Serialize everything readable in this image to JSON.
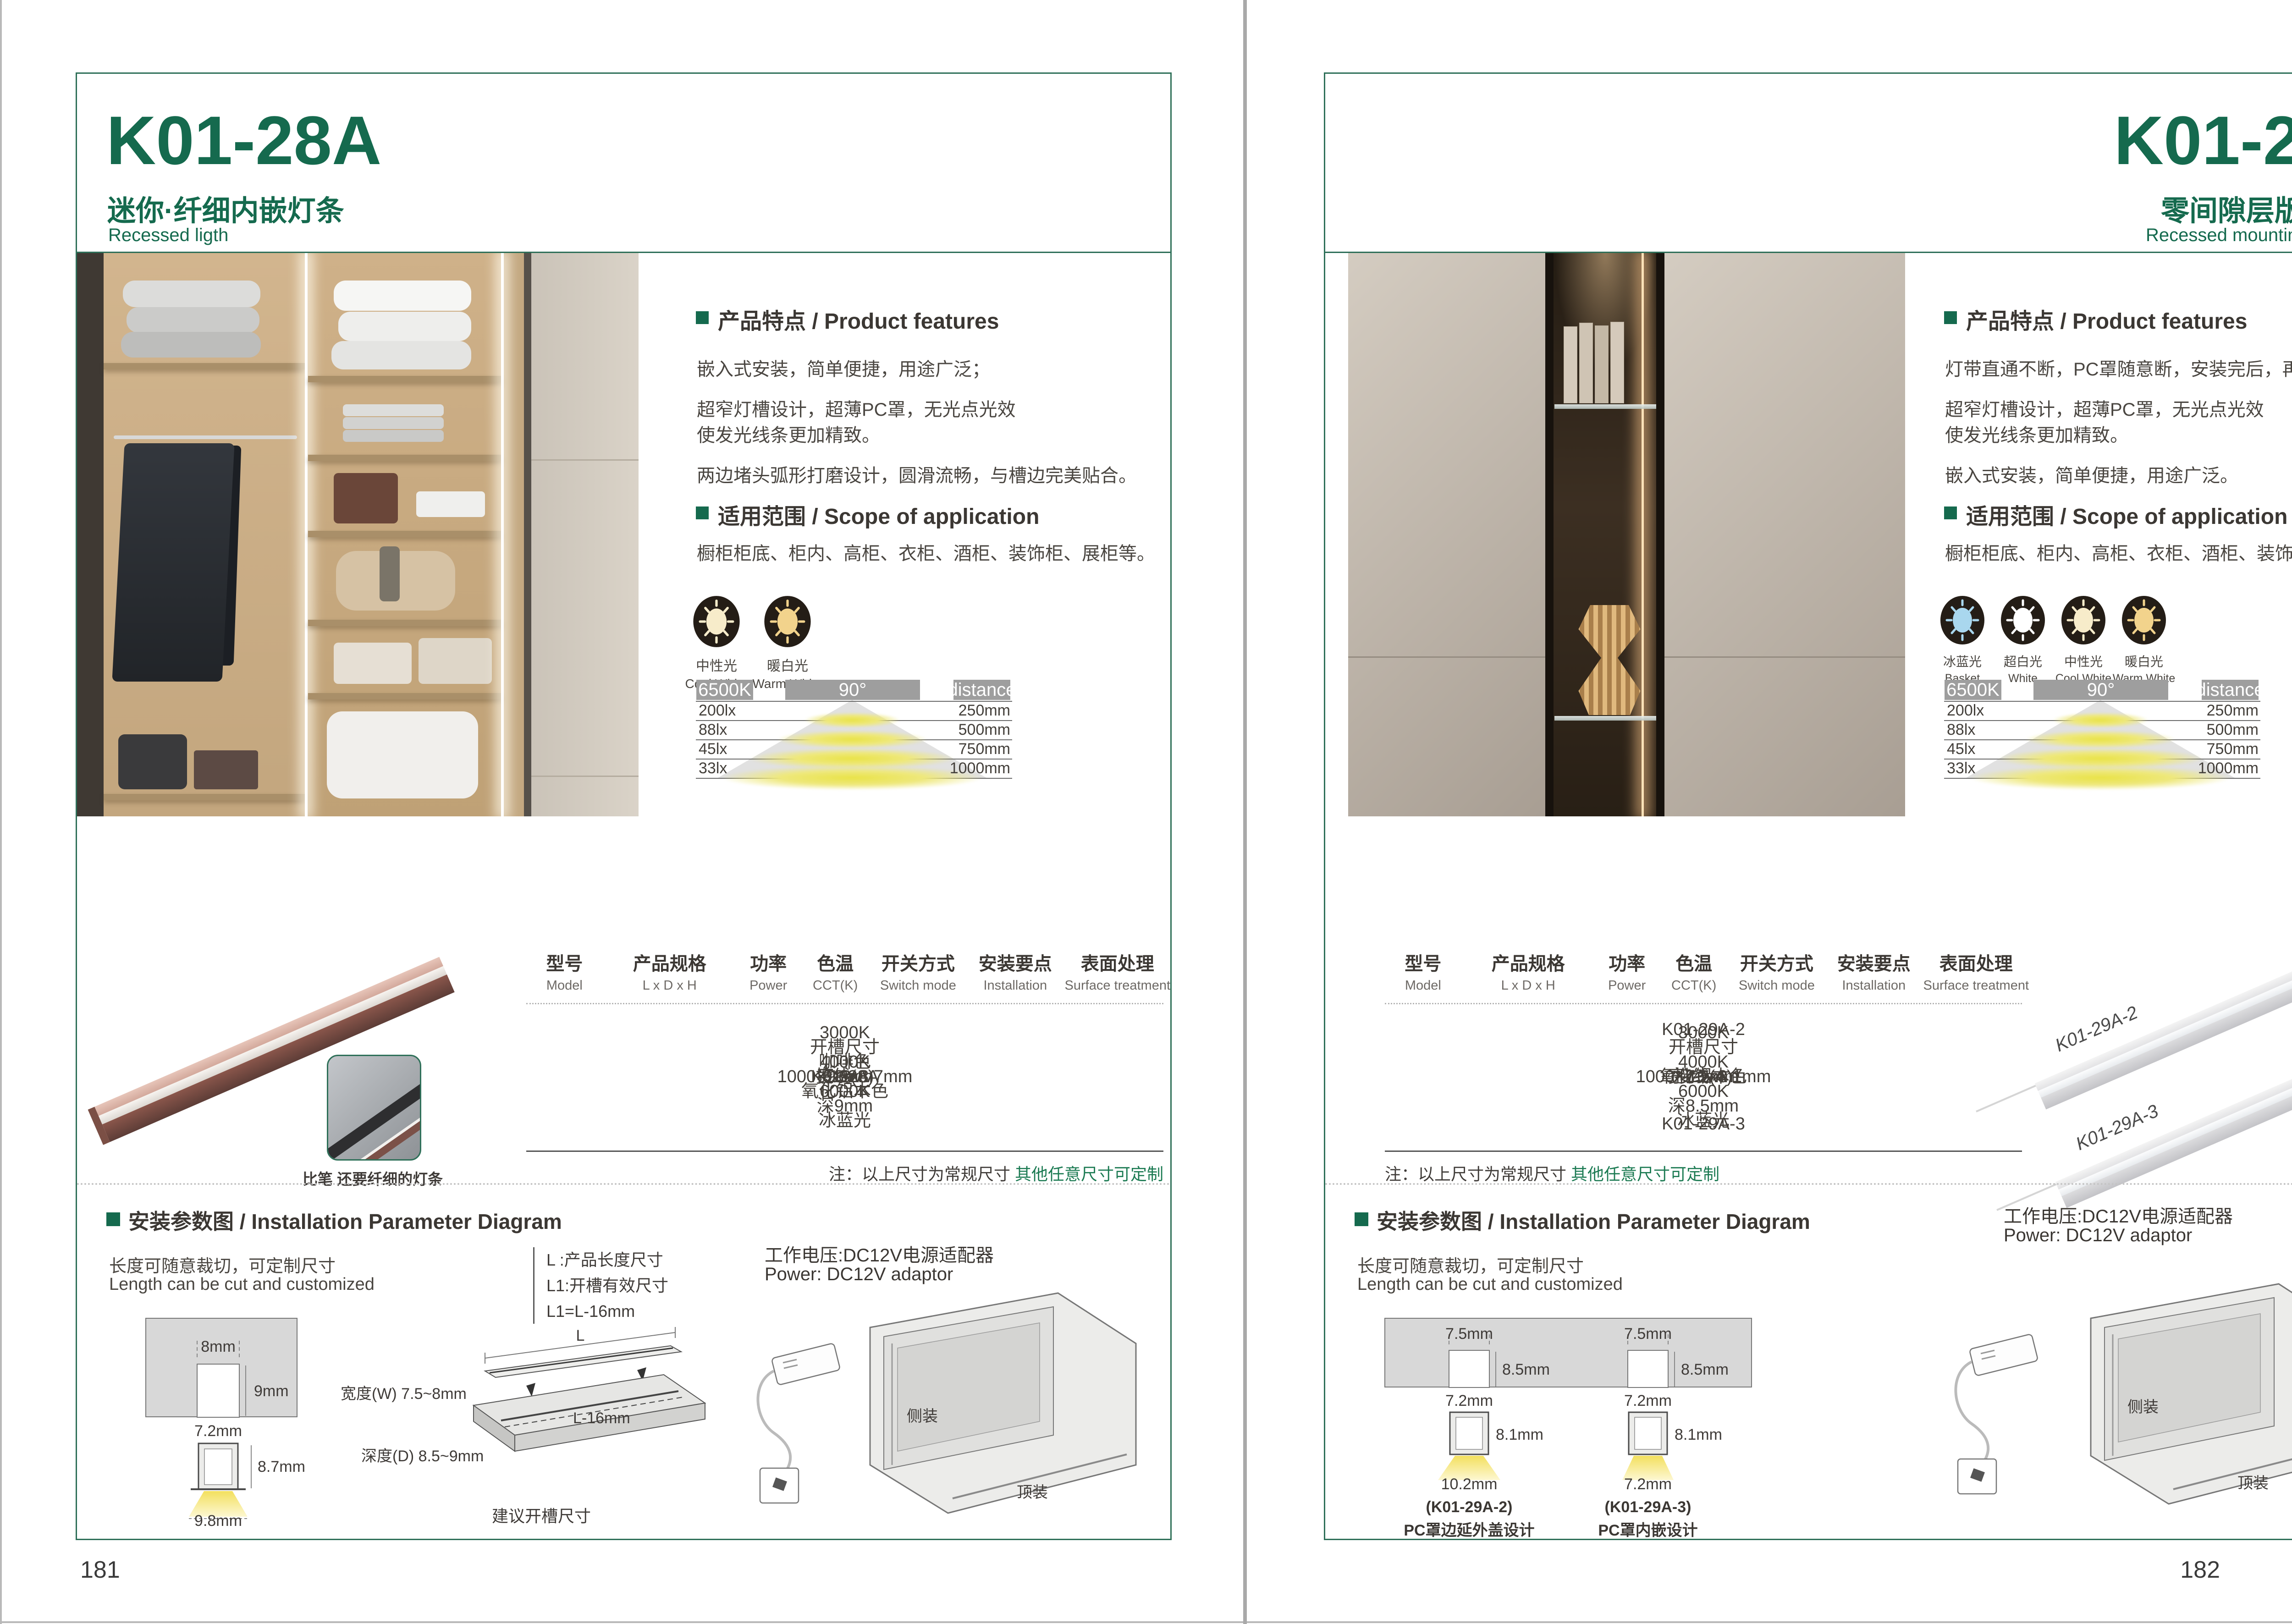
{
  "pages": [
    {
      "page_number": "181",
      "header": {
        "model": "K01-28A",
        "subtitle_cn": "迷你·纤细内嵌灯条",
        "subtitle_en": "Recessed ligth"
      },
      "features": {
        "title": "产品特点 / Product features",
        "lines": [
          "嵌入式安装，简单便捷，用途广泛；",
          "超窄灯槽设计，超薄PC罩，无光点光效",
          "使发光线条更加精致。",
          "两边堵头弧形打磨设计，圆滑流畅，与槽边完美贴合。"
        ]
      },
      "scope": {
        "title": "适用范围 / Scope of application",
        "text": "橱柜柜底、柜内、高柜、衣柜、酒柜、装饰柜、展柜等。"
      },
      "cct_icons": [
        {
          "cn": "中性光",
          "en": "Cool White",
          "color": "#f7ecca"
        },
        {
          "cn": "暖白光",
          "en": "Warm White",
          "color": "#f2d38c"
        }
      ],
      "photometry": {
        "cct": "6500K",
        "angle": "90°",
        "distance": "distance",
        "rows": [
          [
            "200lx",
            "250mm"
          ],
          [
            "88lx",
            "500mm"
          ],
          [
            "45lx",
            "750mm"
          ],
          [
            "33lx",
            "1000mm"
          ]
        ]
      },
      "product": {
        "caption": "比笔 还要纤细的灯条"
      },
      "table": {
        "headers": [
          [
            "型号",
            "Model"
          ],
          [
            "产品规格",
            "L x D x H"
          ],
          [
            "功率",
            "Power"
          ],
          [
            "色温",
            "CCT(K)"
          ],
          [
            "开关方式",
            "Switch mode"
          ],
          [
            "安装要点",
            "Installation"
          ],
          [
            "表面处理",
            "Surface treatment"
          ]
        ],
        "model": "K01-28A",
        "spec": "1000×9.8x8.7mm",
        "power": "10w",
        "cct": [
          "3000K",
          "4000K",
          "6000K",
          "冰蓝光"
        ],
        "switch": "接线(A)",
        "install": [
          "开槽尺寸",
          "宽8mm",
          "深9mm"
        ],
        "surface": [
          "咖啡色",
          "氧化铝本色"
        ],
        "note_black": "注：以上尺寸为常规尺寸 ",
        "note_green": "其他任意尺寸可定制"
      },
      "install": {
        "title": "安装参数图 / Installation Parameter Diagram",
        "cut_cn": "长度可随意裁切，可定制尺寸",
        "cut_en": "Length can be cut and customized",
        "cross": {
          "slot_w": "8mm",
          "slot_d": "9mm",
          "groove_w": "7.2mm",
          "prof_h": "8.7mm",
          "beam_w": "9.8mm"
        },
        "legend": [
          "L :产品长度尺寸",
          "L1:开槽有效尺寸",
          "L1=L-16mm"
        ],
        "board": {
          "len": "L",
          "len_cut": "L-16mm",
          "width": "宽度(W) 7.5~8mm",
          "depth": "深度(D) 8.5~9mm",
          "caption": "建议开槽尺寸"
        },
        "power_cn": "工作电压:DC12V电源适配器",
        "power_en": "Power: DC12V adaptor",
        "side_mount": "侧装",
        "top_mount": "顶装"
      }
    },
    {
      "page_number": "182",
      "header": {
        "model": "K01-29A",
        "subtitle_cn": "零间隙层版条形灯",
        "subtitle_en": "Recessed mounting LED light"
      },
      "features": {
        "title": "产品特点 / Product features",
        "lines": [
          "灯带直通不断，PC罩随意断，安装完后，再盖灯罩；",
          "超窄灯槽设计，超薄PC罩，无光点光效",
          "使发光线条更加精致。",
          "嵌入式安装，简单便捷，用途广泛。"
        ]
      },
      "scope": {
        "title": "适用范围 / Scope of application",
        "text": "橱柜柜底、柜内、高柜、衣柜、酒柜、装饰柜、展柜等。"
      },
      "cct_icons": [
        {
          "cn": "冰蓝光",
          "en": "Basket",
          "color": "#a9d7ee"
        },
        {
          "cn": "超白光",
          "en": "White",
          "color": "#ffffff"
        },
        {
          "cn": "中性光",
          "en": "Cool White",
          "color": "#f7ecca"
        },
        {
          "cn": "暖白光",
          "en": "Warm White",
          "color": "#f2d38c"
        }
      ],
      "photometry": {
        "cct": "6500K",
        "angle": "90°",
        "distance": "distance",
        "rows": [
          [
            "200lx",
            "250mm"
          ],
          [
            "88lx",
            "500mm"
          ],
          [
            "45lx",
            "750mm"
          ],
          [
            "33lx",
            "1000mm"
          ]
        ]
      },
      "product": {
        "labels": [
          "K01-29A-2",
          "K01-29A-3"
        ]
      },
      "table": {
        "headers": [
          [
            "型号",
            "Model"
          ],
          [
            "产品规格",
            "L x D x H"
          ],
          [
            "功率",
            "Power"
          ],
          [
            "色温",
            "CCT(K)"
          ],
          [
            "开关方式",
            "Switch mode"
          ],
          [
            "安装要点",
            "Installation"
          ],
          [
            "表面处理",
            "Surface treatment"
          ]
        ],
        "models": [
          "K01-29A-2",
          "K01-29A-3"
        ],
        "spec": "1000×7.2x8.1mm",
        "power": "10w",
        "cct": [
          "3000K",
          "4000K",
          "6000K",
          "冰蓝光"
        ],
        "switch": "接线(A)",
        "install": [
          "开槽尺寸",
          "宽7.5mm",
          "深8.5mm"
        ],
        "surface": [
          "氧化铝本色"
        ],
        "note_black": "注：以上尺寸为常规尺寸 ",
        "note_green": "其他任意尺寸可定制"
      },
      "install": {
        "title": "安装参数图 / Installation Parameter Diagram",
        "cut_cn": "长度可随意裁切，可定制尺寸",
        "cut_en": "Length can be cut and customized",
        "sections": [
          {
            "slot_w": "7.5mm",
            "slot_d": "8.5mm",
            "groove_w": "7.2mm",
            "prof_h": "8.1mm",
            "beam_w": "10.2mm",
            "model": "(K01-29A-2)",
            "desc": "PC罩边延外盖设计"
          },
          {
            "slot_w": "7.5mm",
            "slot_d": "8.5mm",
            "groove_w": "7.2mm",
            "prof_h": "8.1mm",
            "beam_w": "7.2mm",
            "model": "(K01-29A-3)",
            "desc": "PC罩内嵌设计"
          }
        ],
        "power_cn": "工作电压:DC12V电源适配器",
        "power_en": "Power: DC12V adaptor",
        "side_mount": "侧装",
        "top_mount": "顶装"
      }
    }
  ]
}
